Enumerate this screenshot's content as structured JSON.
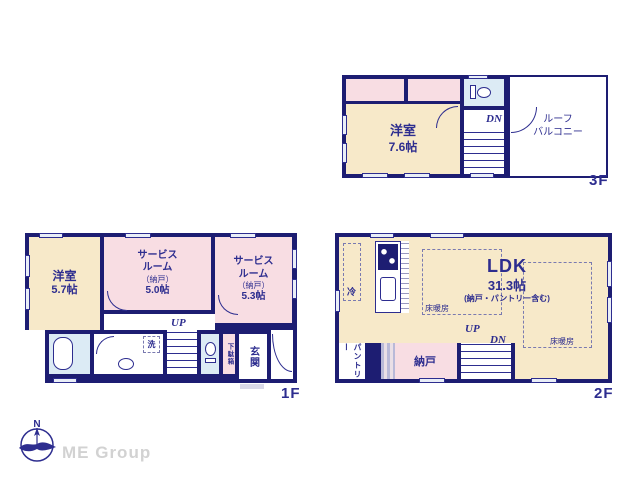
{
  "brand": {
    "logo_text": "ME Group"
  },
  "compass": {
    "north_label": "N"
  },
  "colors": {
    "wall": "#1d1d72",
    "cream": "#f7e9c9",
    "pink": "#f8dde3",
    "blue": "#dcebf5",
    "text": "#2d2d8f"
  },
  "f3": {
    "floor_label": "3F",
    "bedroom": {
      "name": "洋室",
      "size": "7.6帖"
    },
    "balcony_l1": "ルーフ",
    "balcony_l2": "バルコニー",
    "dn": "DN"
  },
  "f1": {
    "floor_label": "1F",
    "bedroom": {
      "name": "洋室",
      "size": "5.7帖"
    },
    "service1": {
      "l1": "サービス",
      "l2": "ルーム",
      "l3": "（納戸）",
      "size": "5.0帖"
    },
    "service2": {
      "l1": "サービス",
      "l2": "ルーム",
      "l3": "（納戸）",
      "size": "5.3帖"
    },
    "up": "UP",
    "laundry": "洗",
    "shoebox": "下駄箱",
    "entrance": "玄関"
  },
  "f2": {
    "floor_label": "2F",
    "ldk": {
      "name": "LDK",
      "size": "31.3帖",
      "note": "(納戸・パントリー含む)"
    },
    "heating": "床暖房",
    "fridge": "冷",
    "pantry": "パントリー",
    "storage": "納戸",
    "up": "UP",
    "dn": "DN"
  }
}
